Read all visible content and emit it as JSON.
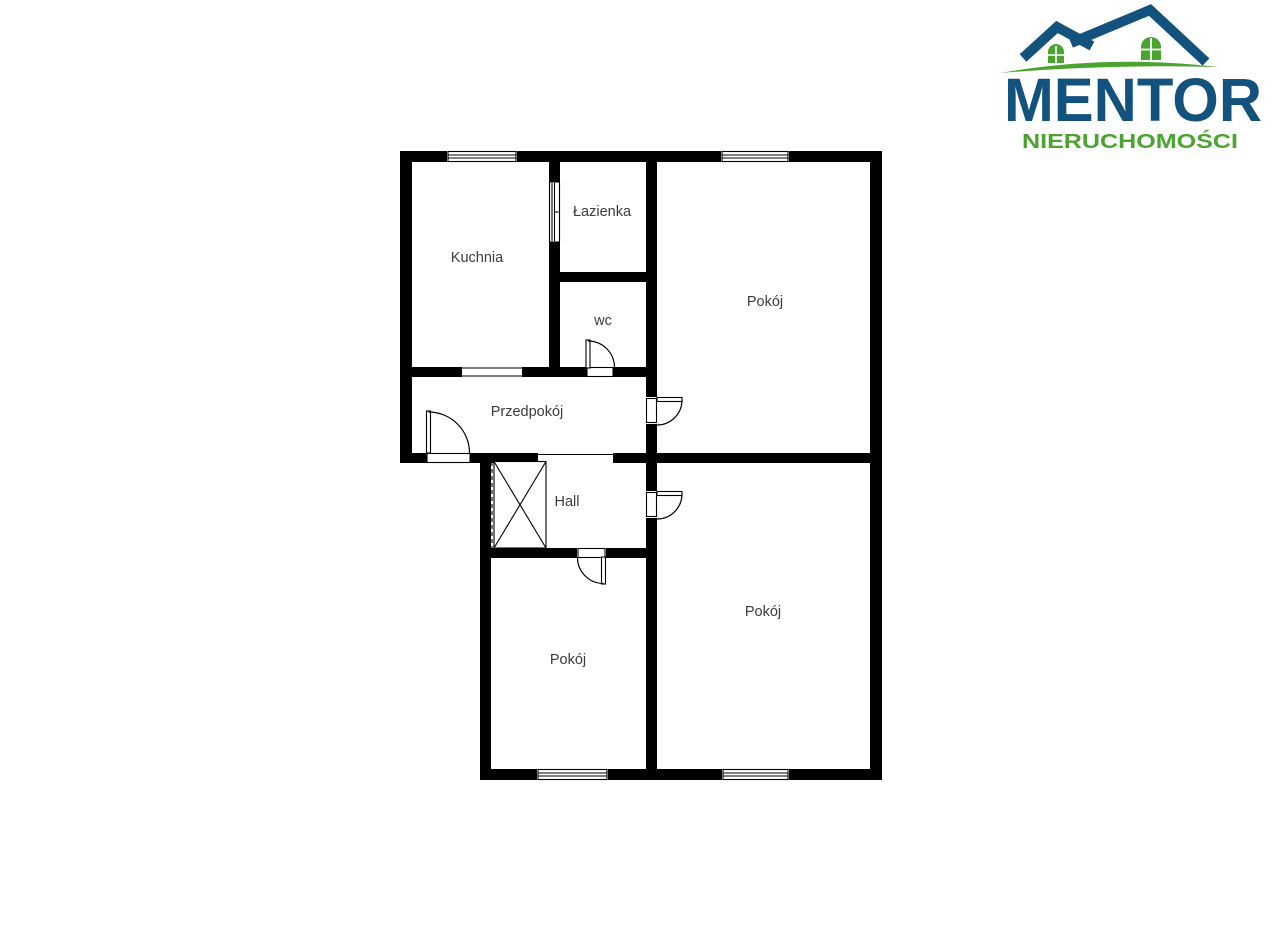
{
  "page": {
    "background_color": "#ffffff"
  },
  "logo": {
    "brand": "MENTOR",
    "tagline": "NIERUCHOMOŚCI",
    "brand_color": "#14527E",
    "tagline_color": "#4BA42F",
    "house_roof_color": "#14527E",
    "house_window_color": "#4BA42F",
    "ground_swoosh_color": "#4BA42F"
  },
  "floor_plan": {
    "wall_color": "#000000",
    "label_color": "#3C3C3C",
    "rooms": [
      {
        "label": "Kuchnia"
      },
      {
        "label": "Łazienka"
      },
      {
        "label": "wc"
      },
      {
        "label": "Pokój"
      },
      {
        "label": "Przedpokój"
      },
      {
        "label": "Hall"
      },
      {
        "label": "Pokój"
      },
      {
        "label": "Pokój"
      }
    ]
  }
}
